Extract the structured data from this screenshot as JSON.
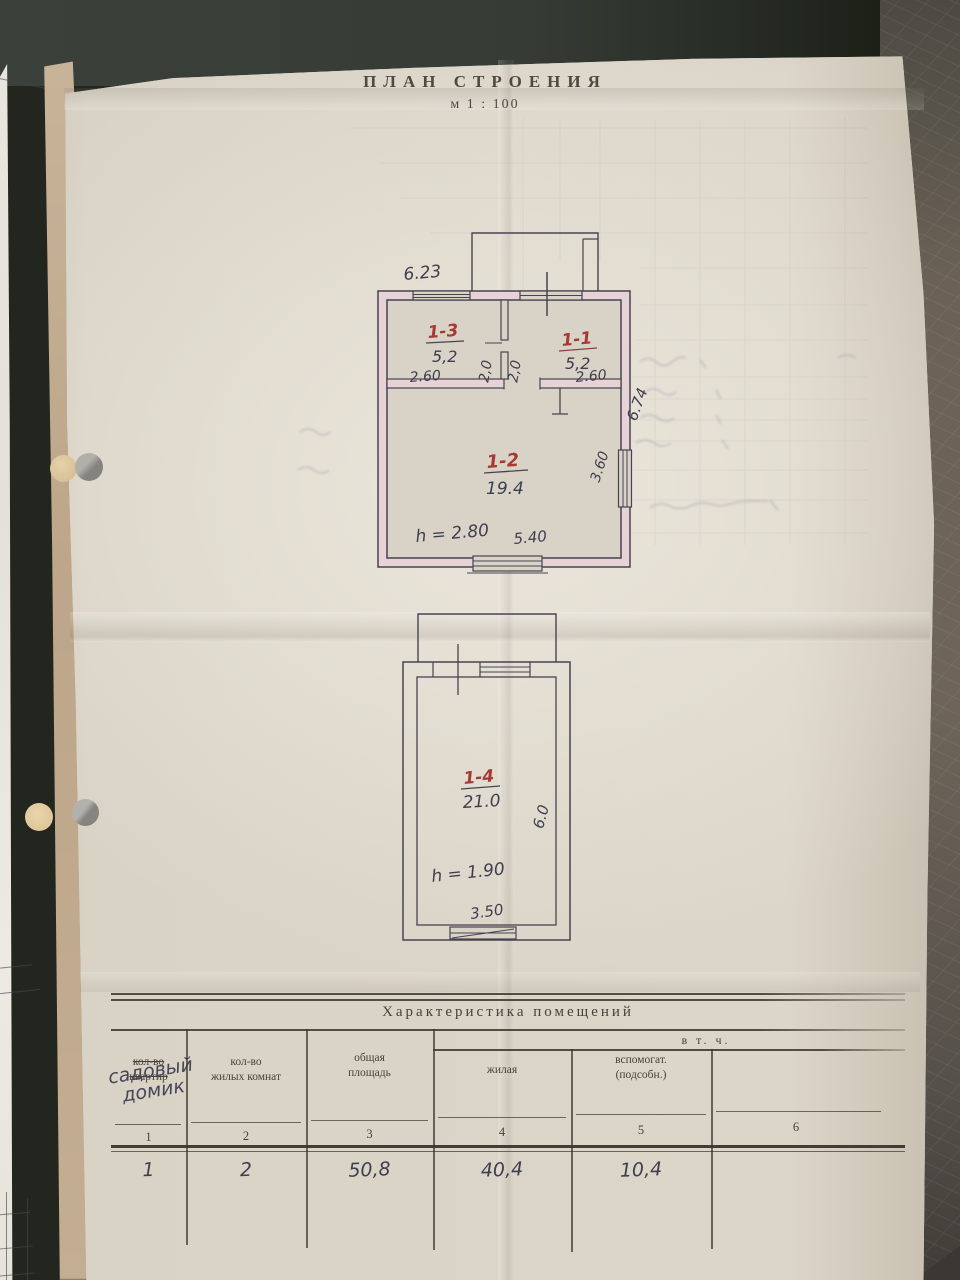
{
  "document": {
    "title": "ПЛАН СТРОЕНИЯ",
    "scale": "м 1 : 100"
  },
  "upper_plan": {
    "dim_width_top": "6.23",
    "room_13": {
      "no": "1-3",
      "area": "5,2"
    },
    "room_11": {
      "no": "1-1",
      "area": "5,2"
    },
    "room_12": {
      "no": "1-2",
      "area": "19.4"
    },
    "dim_room13_width": "2.60",
    "dim_door_left": "2,0",
    "dim_door_right": "2,0",
    "dim_room11_width": "2.60",
    "dim_side_right": "6.74",
    "dim_window_right": "3.60",
    "dim_height": "h = 2.80",
    "dim_window_bottom": "5.40"
  },
  "lower_plan": {
    "room_14": {
      "no": "1-4",
      "area": "21.0"
    },
    "dim_side_right": "6.0",
    "dim_height": "h = 1.90",
    "dim_width_bottom": "3.50"
  },
  "table": {
    "title": "Характеристика помещений",
    "incl": "в т. ч.",
    "col1": {
      "line1": "кол-во",
      "line2": "квартир",
      "hand1": "садовый",
      "hand2": "домик",
      "num": "1",
      "value": "1"
    },
    "col2": {
      "line1": "кол-во",
      "line2": "жилых комнат",
      "num": "2",
      "value": "2"
    },
    "col3": {
      "line1": "общая",
      "line2": "площадь",
      "num": "3",
      "value": "50,8"
    },
    "col4": {
      "line1": "жилая",
      "num": "4",
      "value": "40,4"
    },
    "col5": {
      "line1": "вспомогат.",
      "line2": "(подсобн.)",
      "num": "5",
      "value": "10,4"
    },
    "col6": {
      "num": "6"
    }
  }
}
